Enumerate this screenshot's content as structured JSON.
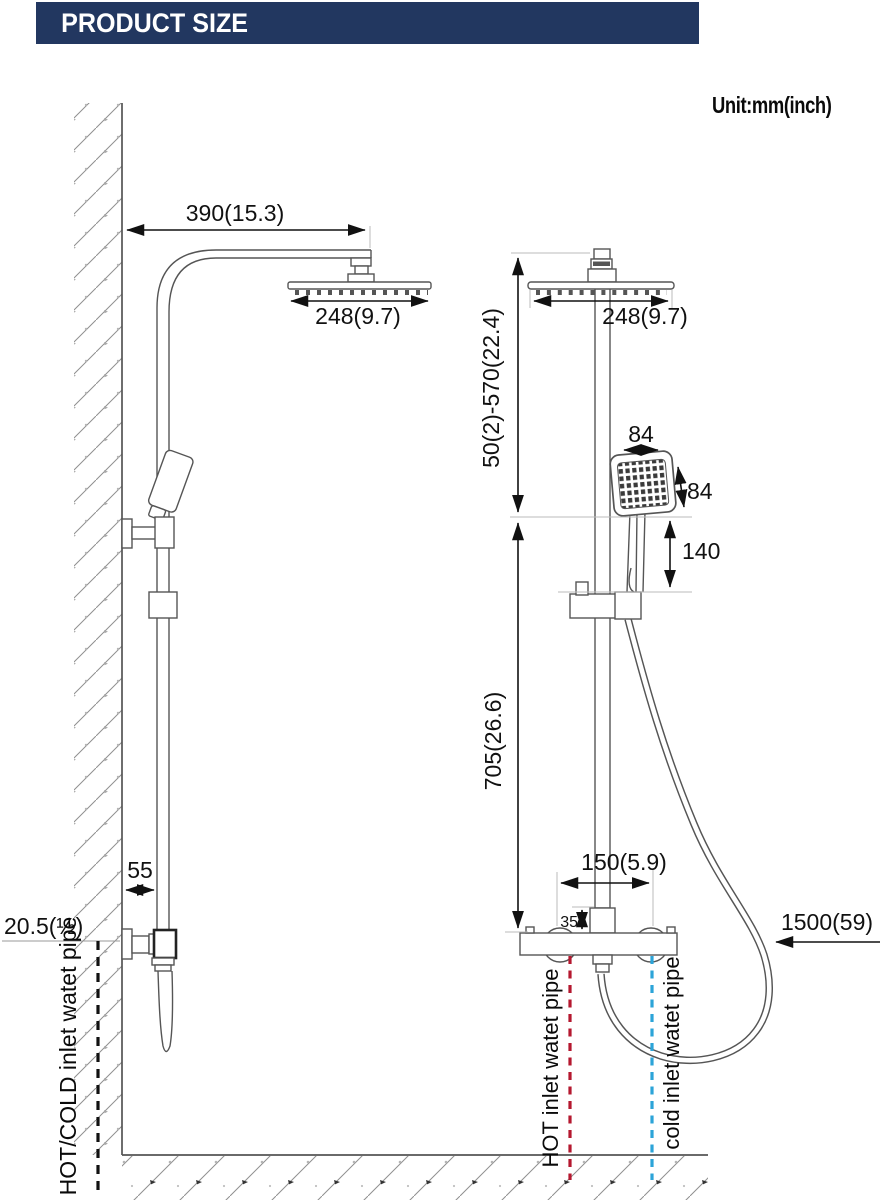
{
  "header": {
    "title": "PRODUCT SIZE"
  },
  "unit_label": "Unit:mm(inch)",
  "side_view": {
    "dim_arm_length": "390(15.3)",
    "dim_head_width": "248(9.7)",
    "dim_wall_to_pipe": "55",
    "dim_inlet_size": "20.5(½)",
    "label_inlet": "HOT/COLD inlet watet pipe"
  },
  "front_view": {
    "dim_head_width": "248(9.7)",
    "dim_height_range": "50(2)-570(22.4)",
    "dim_pole_height": "705(26.6)",
    "dim_hand_width": "84",
    "dim_hand_face": "84",
    "dim_handle_length": "140",
    "dim_inlet_spacing": "150(5.9)",
    "dim_valve_offset": "35",
    "dim_hose_length": "1500(59)",
    "label_hot": "HOT inlet watet pipe",
    "label_cold": "cold inlet watet pipe"
  },
  "colors": {
    "header_navy": "#223760",
    "drawing_line": "#555555",
    "dimension_line": "#111111",
    "hot_line": "#b5182f",
    "cold_line": "#2ca4d8"
  }
}
